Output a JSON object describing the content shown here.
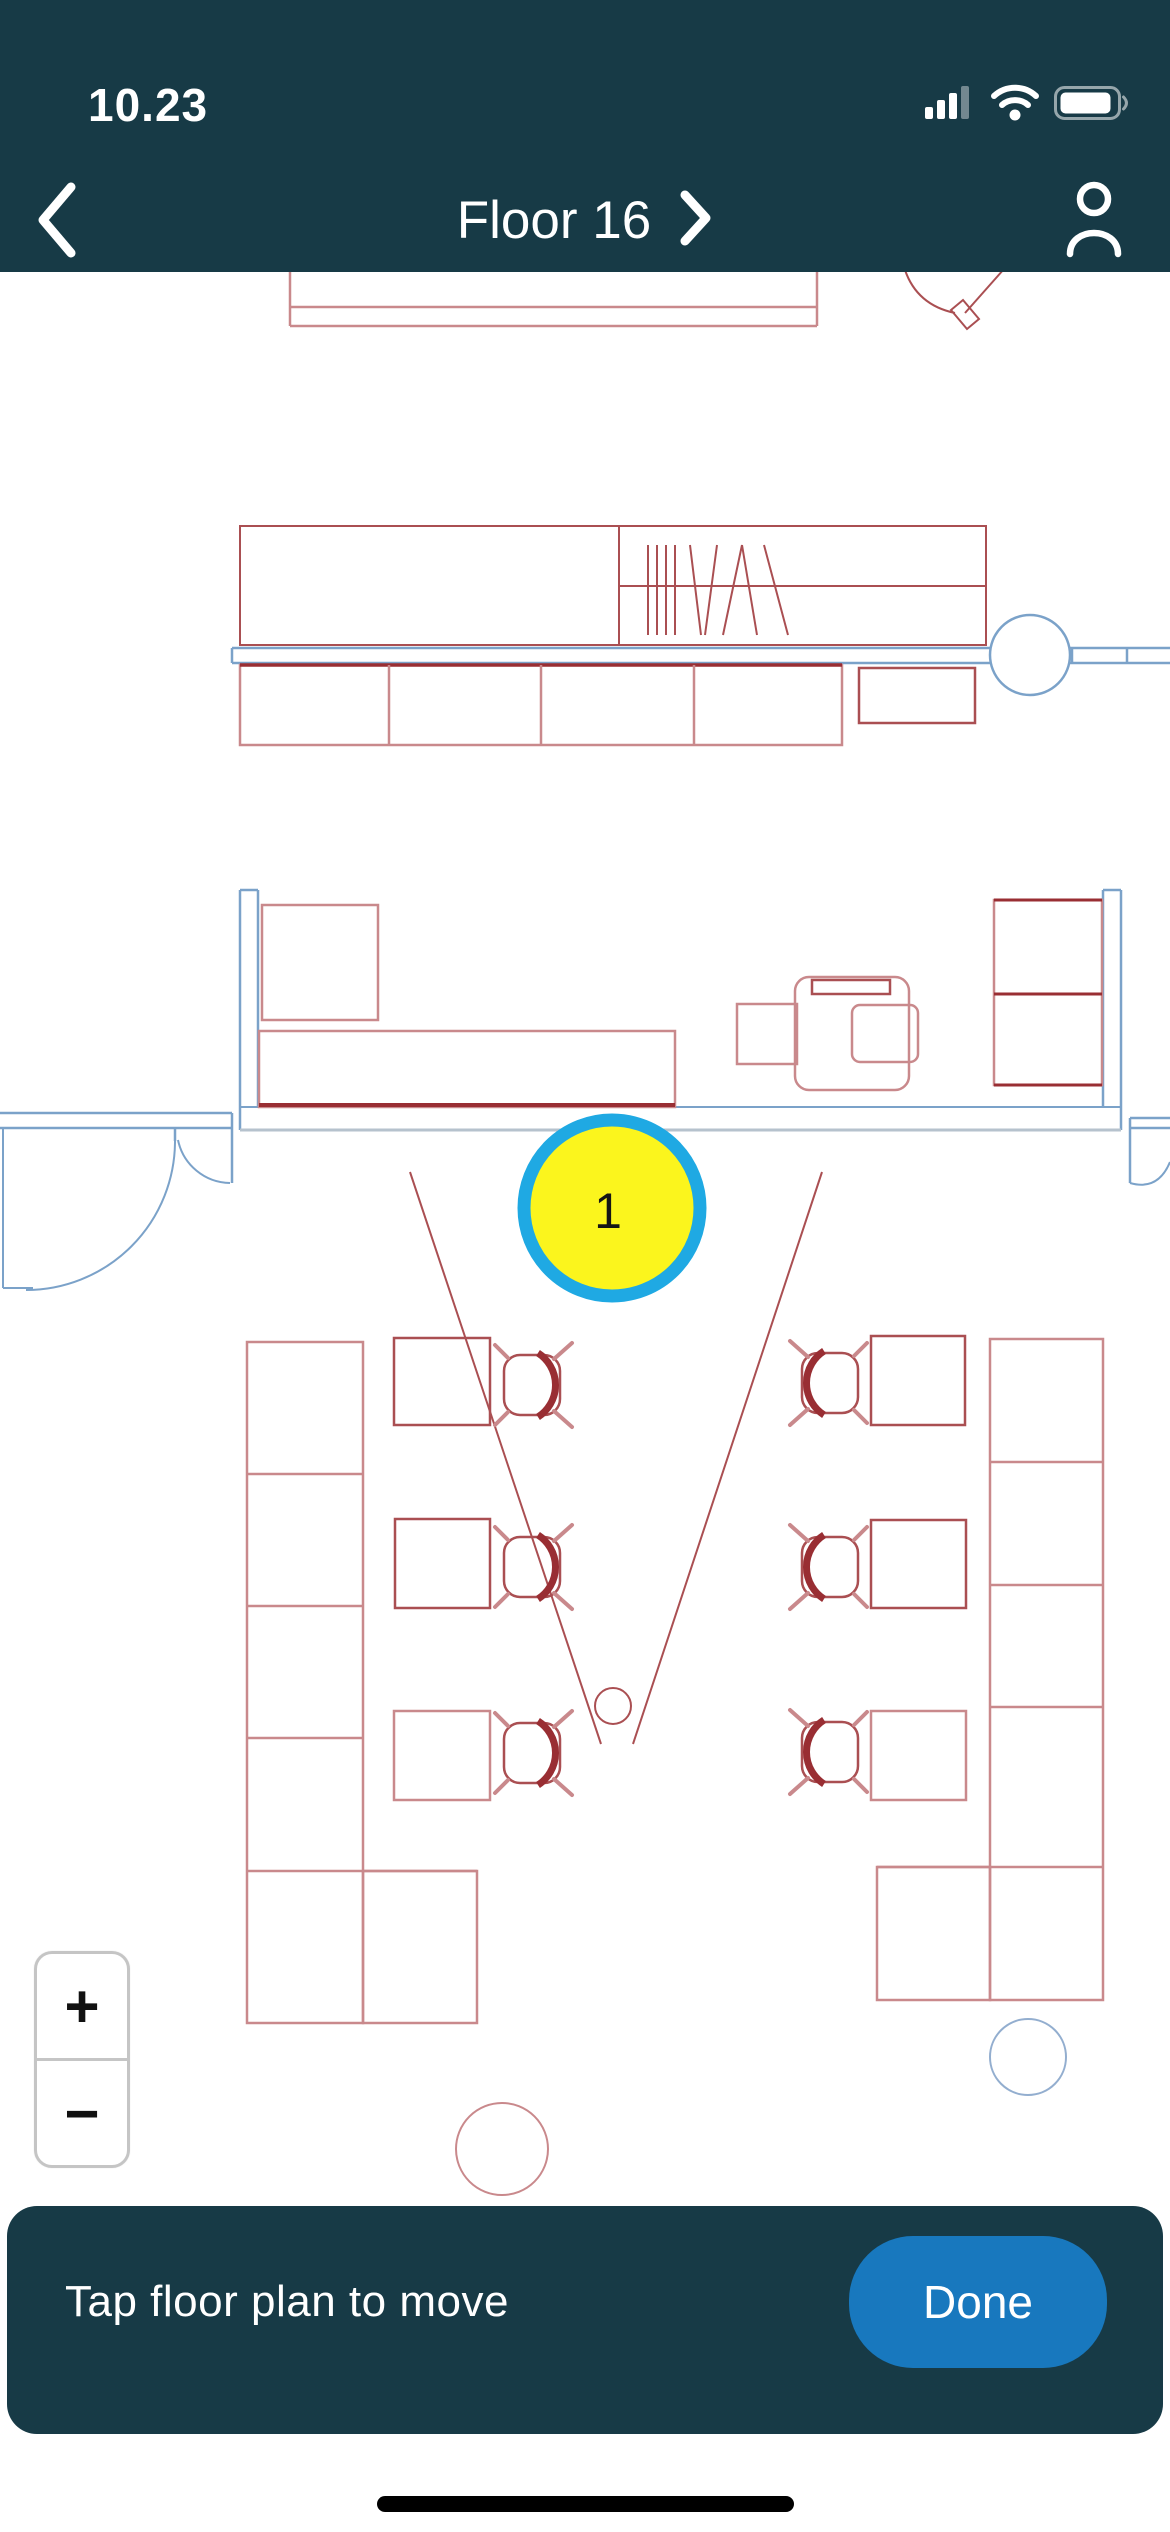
{
  "status_bar": {
    "time": "10.23",
    "icons": [
      "cellular-signal",
      "wifi",
      "battery"
    ]
  },
  "nav_bar": {
    "title": "Floor 16",
    "back_icon": "chevron-left",
    "title_chevron": "chevron-right",
    "profile_icon": "person"
  },
  "theme": {
    "header_color": "#173A46",
    "bar_color": "#173A46",
    "done_blue": "#1878BE",
    "white": "#ffffff"
  },
  "zoom_controls": {
    "zoom_in_label": "+",
    "zoom_out_label": "−"
  },
  "bottom_bar": {
    "hint": "Tap floor plan to move",
    "done_label": "Done"
  },
  "floor_plan": {
    "colors": {
      "r": "#AA4F52",
      "rl": "#C9898C",
      "rd": "#992E33",
      "b": "#7BA2C9",
      "bl": "#93AECF",
      "gray": "#B6C2CD"
    },
    "marker": {
      "label": "1",
      "cx": 612,
      "cy": 1208,
      "r": 88,
      "fill": "#FBF51D",
      "ring": "#1FA9E3",
      "ring_width": 13,
      "label_color": "#151515",
      "label_size": 50
    },
    "shapes": [
      {
        "t": "path",
        "d": "M290,270 V326 M817,270 V326 M290,307 H817 M290,326 H817",
        "s": "rl",
        "sw": 2.5,
        "n": "counter-top"
      },
      {
        "t": "path",
        "d": "M905,270 Q917,305 955,313",
        "s": "r",
        "sw": 2,
        "n": "door-arc-top"
      },
      {
        "t": "path",
        "d": "M951,310 L963,300 L979,319 L967,329 Z",
        "s": "r",
        "sw": 2,
        "n": "door-leaf-top"
      },
      {
        "t": "line",
        "x1": 965,
        "y1": 313,
        "x2": 1004,
        "y2": 269,
        "s": "r",
        "sw": 2,
        "n": "door-line-top"
      },
      {
        "t": "rect",
        "x": 240,
        "y": 526,
        "w": 746,
        "h": 119,
        "s": "r",
        "sw": 2,
        "n": "cabinet-row"
      },
      {
        "t": "line",
        "x1": 619,
        "y1": 526,
        "x2": 619,
        "y2": 645,
        "s": "r",
        "sw": 2,
        "n": "cabinet-divider"
      },
      {
        "t": "line",
        "x1": 619,
        "y1": 586,
        "x2": 986,
        "y2": 586,
        "s": "r",
        "sw": 2,
        "n": "cabinet-shelf-line"
      },
      {
        "t": "path",
        "d": "M648,545 V635 M657,545 V635 M666,545 V635 M675,545 V635 M690,545 L701,635 M717,545 L705,635 M723,635 L742,545 M742,545 L757,635 M764,545 L788,635",
        "s": "r",
        "sw": 2,
        "n": "hatch-marks"
      },
      {
        "t": "path",
        "d": "M232,648 H1170 M232,663 H1170 M232,648 V663 M1072,648 V663 M1127,648 V663",
        "s": "b",
        "sw": 2.5,
        "n": "corridor-wall"
      },
      {
        "t": "circle",
        "cx": 1030,
        "cy": 655,
        "r": 40,
        "s": "b",
        "sw": 2.5,
        "f": "#ffffff",
        "n": "column-circle"
      },
      {
        "t": "rect",
        "x": 240,
        "y": 665,
        "w": 602,
        "h": 80,
        "s": "rl",
        "sw": 2.5,
        "n": "counter-row"
      },
      {
        "t": "line",
        "x1": 240,
        "y1": 665,
        "x2": 842,
        "y2": 665,
        "s": "rd",
        "sw": 3.5,
        "n": "counter-edge"
      },
      {
        "t": "path",
        "d": "M389,665 V745 M541,665 V745 M694,665 V745",
        "s": "rl",
        "sw": 2.5,
        "n": "counter-dividers"
      },
      {
        "t": "rect",
        "x": 859,
        "y": 668,
        "w": 116,
        "h": 55,
        "s": "r",
        "sw": 2.5,
        "n": "side-table"
      },
      {
        "t": "path",
        "d": "M240,890 H258 M240,890 V1130 M258,890 V1107",
        "s": "b",
        "sw": 2.5,
        "n": "room-wall-left"
      },
      {
        "t": "path",
        "d": "M1103,890 H1121 M1121,890 V1130 M1103,890 V1107",
        "s": "b",
        "sw": 2.5,
        "n": "room-wall-right"
      },
      {
        "t": "path",
        "d": "M240,1107 H1121",
        "s": "b",
        "sw": 2,
        "n": "room-wall-bottom-inner"
      },
      {
        "t": "path",
        "d": "M240,1130 H1121",
        "s": "gray",
        "sw": 3,
        "n": "room-wall-bottom-outer"
      },
      {
        "t": "rect",
        "x": 262,
        "y": 905,
        "w": 116,
        "h": 115,
        "s": "rl",
        "sw": 2.5,
        "n": "room-cabinet"
      },
      {
        "t": "rect",
        "x": 259,
        "y": 1031,
        "w": 416,
        "h": 76,
        "s": "rl",
        "sw": 2.5,
        "n": "room-credenza"
      },
      {
        "t": "line",
        "x1": 259,
        "y1": 1105,
        "x2": 675,
        "y2": 1105,
        "s": "rd",
        "sw": 4,
        "n": "credenza-edge"
      },
      {
        "t": "rect",
        "x": 737,
        "y": 1004,
        "w": 60,
        "h": 60,
        "s": "rl",
        "sw": 2.5,
        "n": "printer-side-table"
      },
      {
        "t": "rect",
        "x": 795,
        "y": 977,
        "w": 114,
        "h": 113,
        "rx": 14,
        "s": "rl",
        "sw": 2.5,
        "n": "printer-station"
      },
      {
        "t": "rect",
        "x": 812,
        "y": 980,
        "w": 78,
        "h": 14,
        "s": "r",
        "sw": 2.5,
        "n": "printer-tray"
      },
      {
        "t": "rect",
        "x": 852,
        "y": 1005,
        "w": 66,
        "h": 57,
        "rx": 8,
        "s": "rl",
        "sw": 2.5,
        "n": "printer-body"
      },
      {
        "t": "rect",
        "x": 994,
        "y": 900,
        "w": 108,
        "h": 185,
        "s": "rl",
        "sw": 2.5,
        "n": "room-shelf"
      },
      {
        "t": "path",
        "d": "M994,900 H1102 M994,994 H1102 M994,1085 H1102",
        "s": "rd",
        "sw": 3,
        "n": "room-shelf-edges"
      },
      {
        "t": "path",
        "d": "M0,1113 H232 M0,1128 H232 M232,1113 V1128",
        "s": "b",
        "sw": 2.5,
        "n": "entry-wall-left"
      },
      {
        "t": "path",
        "d": "M3,1128 V1288 M3,1288 H33",
        "s": "b",
        "sw": 2,
        "n": "entry-jamb-left"
      },
      {
        "t": "path",
        "d": "M175,1128 V1141",
        "s": "b",
        "sw": 2.5,
        "n": "door-leaf-left"
      },
      {
        "t": "path",
        "d": "M175,1141 A149,149 0 0 1 26,1290",
        "s": "b",
        "sw": 2,
        "n": "door-swing-left"
      },
      {
        "t": "path",
        "d": "M232,1128 V1183",
        "s": "b",
        "sw": 2.5,
        "n": "door-leaf-left-small"
      },
      {
        "t": "path",
        "d": "M178,1140 A54,54 0 0 0 230,1183",
        "s": "b",
        "sw": 2,
        "n": "door-swing-left-small"
      },
      {
        "t": "path",
        "d": "M1130,1118 H1170 M1130,1128 H1170 M1130,1118 V1183",
        "s": "b",
        "sw": 2.5,
        "n": "entry-wall-right"
      },
      {
        "t": "path",
        "d": "M1130,1183 Q1158,1191 1170,1162",
        "s": "b",
        "sw": 2,
        "n": "door-swing-right"
      },
      {
        "t": "line",
        "x1": 410,
        "y1": 1172,
        "x2": 601,
        "y2": 1744,
        "s": "r",
        "sw": 2,
        "n": "projection-line-left"
      },
      {
        "t": "line",
        "x1": 822,
        "y1": 1172,
        "x2": 633,
        "y2": 1744,
        "s": "r",
        "sw": 2,
        "n": "projection-line-right"
      },
      {
        "t": "circle",
        "cx": 613,
        "cy": 1706,
        "r": 18,
        "s": "r",
        "sw": 2,
        "f": "none",
        "n": "floor-socket"
      },
      {
        "t": "rect",
        "x": 247,
        "y": 1342,
        "w": 116,
        "h": 681,
        "s": "rl",
        "sw": 2.5,
        "n": "desk-bank-left"
      },
      {
        "t": "path",
        "d": "M247,1474 H363 M247,1606 H363 M247,1738 H363 M247,1871 H477",
        "s": "rl",
        "sw": 2.5,
        "n": "desk-bank-left-dividers"
      },
      {
        "t": "rect",
        "x": 363,
        "y": 1871,
        "w": 114,
        "h": 152,
        "s": "rl",
        "sw": 2.5,
        "n": "desk-bank-left-end"
      },
      {
        "t": "rect",
        "x": 990,
        "y": 1339,
        "w": 113,
        "h": 661,
        "s": "rl",
        "sw": 2.5,
        "n": "desk-bank-right"
      },
      {
        "t": "path",
        "d": "M990,1462 H1103 M990,1585 H1103 M990,1707 H1103 M877,1867 H1103",
        "s": "rl",
        "sw": 2.5,
        "n": "desk-bank-right-dividers"
      },
      {
        "t": "rect",
        "x": 877,
        "y": 1867,
        "w": 113,
        "h": 133,
        "s": "rl",
        "sw": 2.5,
        "n": "desk-bank-right-end"
      },
      {
        "t": "rect",
        "x": 394,
        "y": 1338,
        "w": 96,
        "h": 87,
        "s": "r",
        "sw": 2.5,
        "n": "desk"
      },
      {
        "t": "rect",
        "x": 395,
        "y": 1519,
        "w": 95,
        "h": 89,
        "s": "r",
        "sw": 2.5,
        "n": "desk"
      },
      {
        "t": "rect",
        "x": 394,
        "y": 1711,
        "w": 96,
        "h": 89,
        "s": "rl",
        "sw": 2.5,
        "n": "desk"
      },
      {
        "t": "rect",
        "x": 871,
        "y": 1336,
        "w": 94,
        "h": 89,
        "s": "r",
        "sw": 2.5,
        "n": "desk"
      },
      {
        "t": "rect",
        "x": 871,
        "y": 1520,
        "w": 95,
        "h": 88,
        "s": "r",
        "sw": 2.5,
        "n": "desk"
      },
      {
        "t": "rect",
        "x": 871,
        "y": 1711,
        "w": 95,
        "h": 89,
        "s": "rl",
        "sw": 2.5,
        "n": "desk"
      },
      {
        "t": "circle",
        "cx": 502,
        "cy": 2149,
        "r": 46,
        "s": "rl",
        "sw": 2,
        "f": "none",
        "n": "plan-circle-red"
      },
      {
        "t": "circle",
        "cx": 1028,
        "cy": 2057,
        "r": 38,
        "s": "bl",
        "sw": 2,
        "f": "none",
        "n": "plan-circle-blue"
      }
    ],
    "chairs": [
      {
        "cx": 532,
        "cy": 1385,
        "back": "right"
      },
      {
        "cx": 532,
        "cy": 1567,
        "back": "right"
      },
      {
        "cx": 532,
        "cy": 1753,
        "back": "right"
      },
      {
        "cx": 830,
        "cy": 1383,
        "back": "left"
      },
      {
        "cx": 830,
        "cy": 1567,
        "back": "left"
      },
      {
        "cx": 830,
        "cy": 1752,
        "back": "left"
      }
    ]
  }
}
